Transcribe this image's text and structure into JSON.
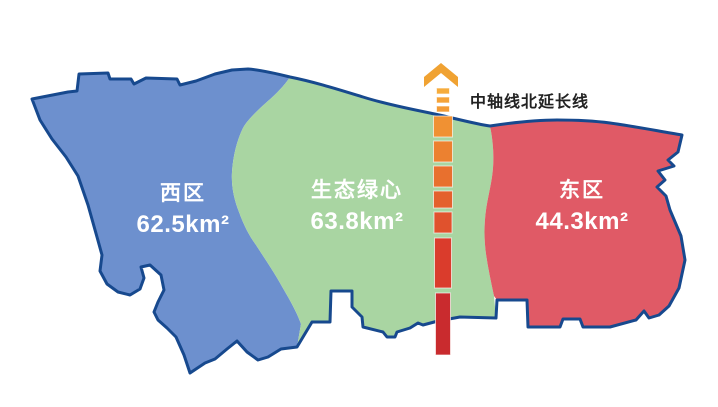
{
  "map": {
    "background": "#FFFFFF",
    "outline_color": "#17498E",
    "region_label_color": "#FFFFFF",
    "regions": [
      {
        "name": "西区",
        "area": "62.5km²",
        "color": "#6D90CE"
      },
      {
        "name": "生态绿心",
        "area": "63.8km²",
        "color": "#A9D5A2"
      },
      {
        "name": "东区",
        "area": "44.3km²",
        "color": "#E05A66"
      }
    ],
    "axis": {
      "label": "中轴线北延长线",
      "label_color": "#222222",
      "arrow_color": "#F0A232",
      "center_x": 443,
      "dashes": [
        {
          "y": 88,
          "h": 6,
          "w": 13,
          "color": "#F6AC3C"
        },
        {
          "y": 97,
          "h": 6,
          "w": 13,
          "color": "#F5A339"
        },
        {
          "y": 106,
          "h": 6,
          "w": 13,
          "color": "#F39B36"
        },
        {
          "y": 116,
          "h": 21,
          "w": 19,
          "color": "#F09133"
        },
        {
          "y": 141,
          "h": 21,
          "w": 19,
          "color": "#EC8130"
        },
        {
          "y": 166,
          "h": 21,
          "w": 19,
          "color": "#E8702E"
        },
        {
          "y": 191,
          "h": 17,
          "w": 19,
          "color": "#E4612D"
        },
        {
          "y": 212,
          "h": 21,
          "w": 18,
          "color": "#E0522D"
        },
        {
          "y": 238,
          "h": 50,
          "w": 17,
          "color": "#DA3C2C"
        },
        {
          "y": 293,
          "h": 62,
          "w": 15,
          "color": "#C92B2E"
        }
      ]
    }
  }
}
